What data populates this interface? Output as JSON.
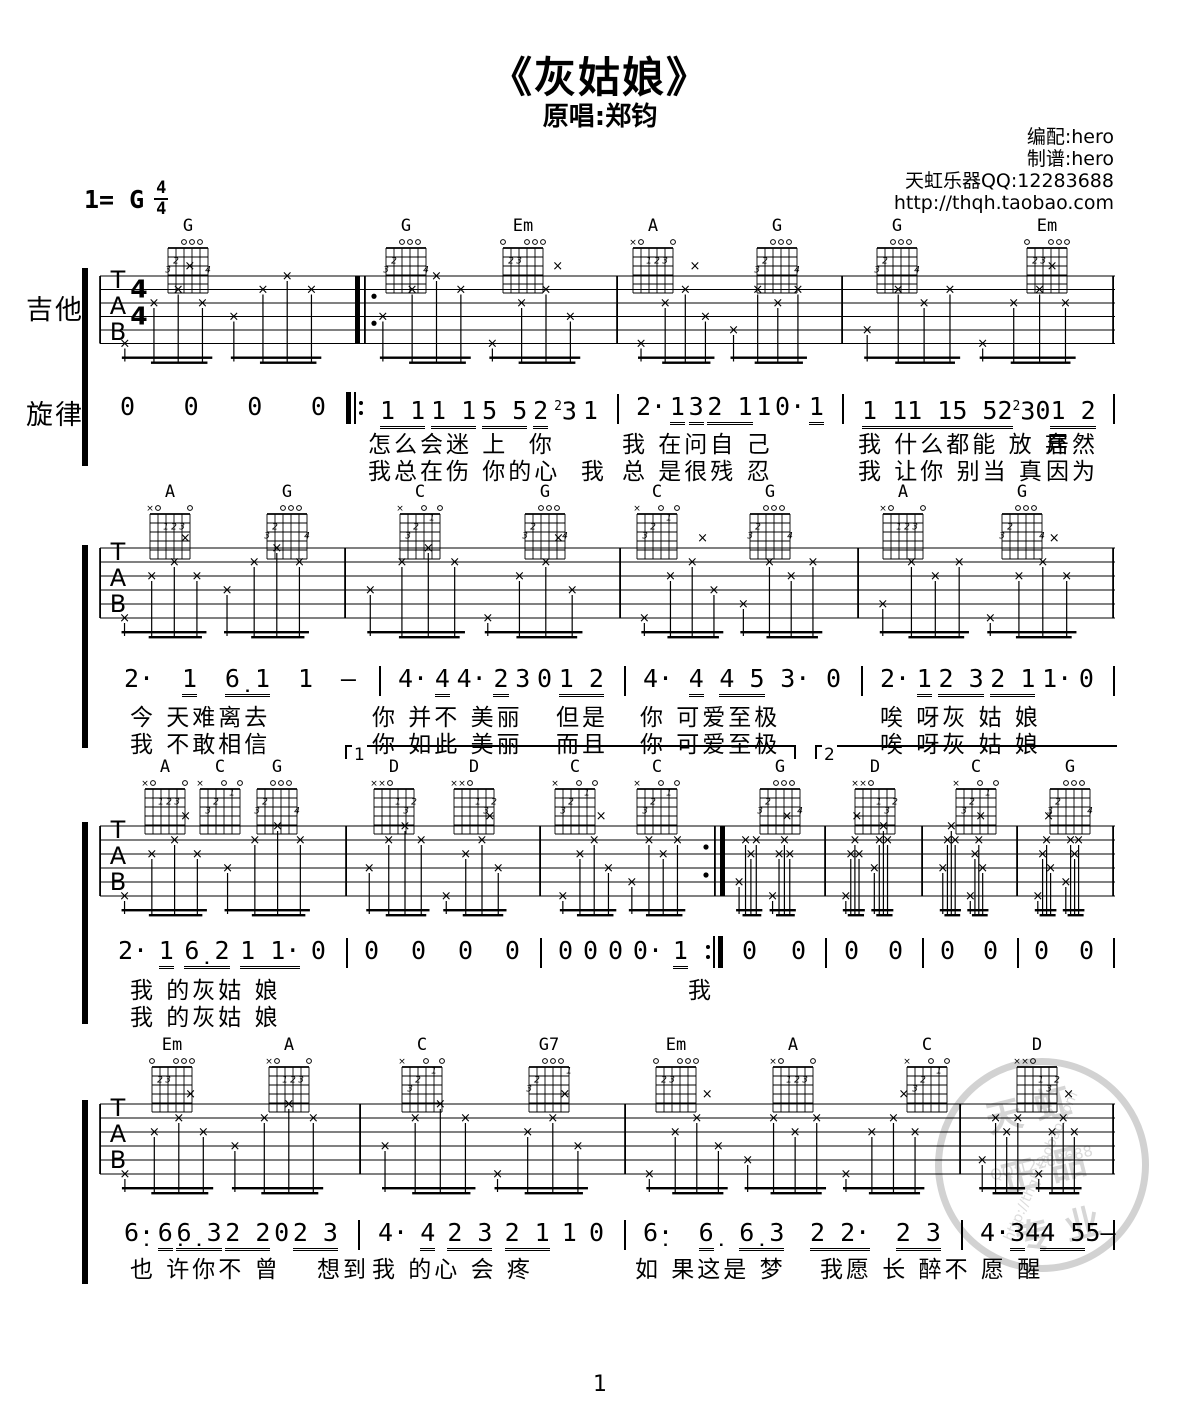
{
  "header": {
    "title": "《灰姑娘》",
    "subtitle": "原唱:郑钧",
    "credits": [
      "编配:hero",
      "制谱:hero",
      "天虹乐器QQ:12283688",
      "http://thqh.taobao.com"
    ],
    "key_label": "1= G",
    "time_top": "4",
    "time_bottom": "4"
  },
  "labels": {
    "guitar": "吉他",
    "melody": "旋律",
    "tab_letters": [
      "T",
      "A",
      "B"
    ]
  },
  "page_number": "1",
  "volta": [
    "1",
    "2"
  ],
  "watermark": {
    "line1": "天虹",
    "line2": "正品",
    "line3": "专业",
    "qq": "QQ:12283688",
    "url": "http://thqh.taobao.com"
  },
  "chord_shapes": {
    "G": {
      "mute": [],
      "open": [
        4,
        3,
        2
      ],
      "dots": [
        [
          5,
          2,
          "2"
        ],
        [
          6,
          3,
          "3"
        ],
        [
          1,
          3,
          "4"
        ]
      ]
    },
    "Em": {
      "mute": [],
      "open": [
        6,
        3,
        2,
        1
      ],
      "dots": [
        [
          5,
          2,
          "2"
        ],
        [
          4,
          2,
          "3"
        ]
      ]
    },
    "A": {
      "mute": [
        6
      ],
      "open": [
        5,
        1
      ],
      "dots": [
        [
          4,
          2,
          "1"
        ],
        [
          3,
          2,
          "2"
        ],
        [
          2,
          2,
          "3"
        ]
      ]
    },
    "C": {
      "mute": [
        6
      ],
      "open": [
        3,
        1
      ],
      "dots": [
        [
          2,
          1,
          "1"
        ],
        [
          4,
          2,
          "2"
        ],
        [
          5,
          3,
          "3"
        ]
      ]
    },
    "D": {
      "mute": [
        6,
        5
      ],
      "open": [
        4
      ],
      "dots": [
        [
          3,
          2,
          "1"
        ],
        [
          1,
          2,
          "2"
        ],
        [
          2,
          3,
          "3"
        ]
      ]
    },
    "G7": {
      "mute": [],
      "open": [
        4,
        3,
        2
      ],
      "dots": [
        [
          1,
          1,
          "1"
        ],
        [
          5,
          2,
          "2"
        ],
        [
          6,
          3,
          "3"
        ]
      ]
    }
  },
  "systems": [
    {
      "chords": [
        "G",
        "G",
        "Em",
        "A",
        "G",
        "G",
        "Em"
      ],
      "measures": [
        "0 0 0 0",
        "{1 1}{1 1}{5 5}{2}²3 1",
        "2·{1}{3}{2 1}1 0·{1}",
        "{1 1}{1 1}{5 5}{2}²3 0{1 2}"
      ],
      "lyrics": [
        [
          "怎么会迷 上  你",
          "我 在问自 己",
          "我 什么都能 放 弃",
          "居然"
        ],
        [
          "我总在伤 你的心  我",
          "总 是很残 忍",
          "我 让你 别当 真",
          "因为"
        ]
      ]
    },
    {
      "chords": [
        "A",
        "G",
        "C",
        "G",
        "C",
        "G",
        "A",
        "G"
      ],
      "measures": [
        "2·{1}{6̣ 1}1 —",
        "4·{4}4·{2}3 0{1 2}",
        "4·{4}{4 5}3· 0",
        "2·{1}{2 3}{2 1}1· 0"
      ],
      "lyrics": [
        [
          "今 天难离去",
          "你 并不 美丽",
          "但是",
          "你 可爱至极",
          "唉 呀灰 姑 娘"
        ],
        [
          "我 不敢相信",
          "你 如此 美丽",
          "而且",
          "你 可爱至极",
          "唉 呀灰 姑 娘"
        ]
      ]
    },
    {
      "chords": [
        "A",
        "C",
        "G",
        "D",
        "D",
        "C",
        "C",
        "G",
        "D",
        "C",
        "G"
      ],
      "measures": [
        "2·{1}{6̣ 2}{1 1·} 0",
        "0 0 0 0",
        "0 0 0 0·{1}",
        "0 0",
        "0 0",
        "0 0",
        "0 0"
      ],
      "lyrics": [
        [
          "我 的灰姑 娘",
          "我"
        ],
        [
          "我 的灰姑 娘"
        ]
      ]
    },
    {
      "chords": [
        "Em",
        "A",
        "C",
        "G7",
        "Em",
        "A",
        "C",
        "D"
      ],
      "measures": [
        "6̣·{6̣}{6̣ 3}{2 2} 0{2 3}",
        "4·{4}{2 3}{2 1}1 0",
        "6̣·{6̣}{6̣ 3}{2 2·} {2 3}",
        "4·{3}4{4 5}5 —"
      ],
      "lyrics": [
        [
          "也 许你不 曾",
          "想到",
          "我 的心 会 疼",
          "如 果这是 梦",
          "我愿 长 醉不 愿 醒"
        ]
      ]
    }
  ]
}
